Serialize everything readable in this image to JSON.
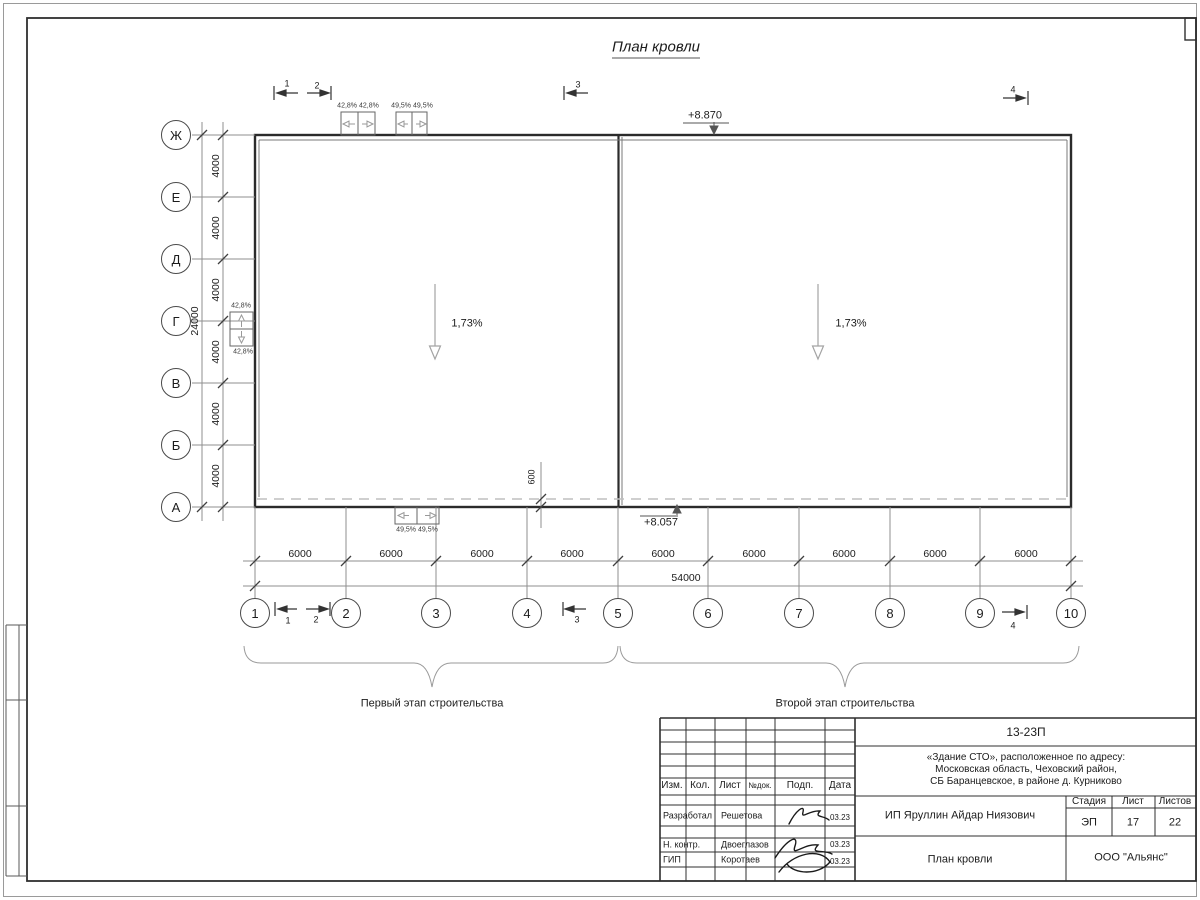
{
  "sheet": {
    "title": "План кровли"
  },
  "plan": {
    "elevation_top": "+8.870",
    "elevation_bottom": "+8.057",
    "slope_left": "1,73%",
    "slope_right": "1,73%",
    "offset_dim": "600",
    "row_axes": [
      "Ж",
      "Е",
      "Д",
      "Г",
      "В",
      "Б",
      "А"
    ],
    "col_axes": [
      "1",
      "2",
      "3",
      "4",
      "5",
      "6",
      "7",
      "8",
      "9",
      "10"
    ],
    "row_dim": "4000",
    "row_total": "24000",
    "col_dim": "6000",
    "col_total": "54000",
    "vent_top_pair1": "42,8% 42,8%",
    "vent_top_pair2": "49,5% 49,5%",
    "vent_left_top": "42,8%",
    "vent_left_bottom": "42,8%",
    "vent_bottom_pair": "49,5% 49,5%",
    "sections": [
      "1",
      "2",
      "3",
      "4"
    ],
    "stage1": "Первый этап строительства",
    "stage2": "Второй этап строительства"
  },
  "titleblock": {
    "code": "13-23П",
    "address1": "«Здание СТО», расположенное по адресу:",
    "address2": "Московская область, Чеховский район,",
    "address3": "СБ Баранцевское, в районе д. Курниково",
    "col_izm": "Изм.",
    "col_kol": "Кол.",
    "col_list": "Лист",
    "col_ndok": "№док.",
    "col_podp": "Подп.",
    "col_data": "Дата",
    "rows": [
      {
        "role": "Разработал",
        "name": "Решетова",
        "date": "03.23"
      },
      {
        "role": "Н. контр.",
        "name": "Двоеглазов",
        "date": "03.23"
      },
      {
        "role": "ГИП",
        "name": "Коротаев",
        "date": "03.23"
      }
    ],
    "client": "ИП Яруллин Айдар Ниязович",
    "stage_label": "Стадия",
    "sheet_label": "Лист",
    "sheets_label": "Листов",
    "stage": "ЭП",
    "sheet_num": "17",
    "sheets_total": "22",
    "doc_title": "План кровли",
    "company": "ООО \"Альянс\""
  }
}
